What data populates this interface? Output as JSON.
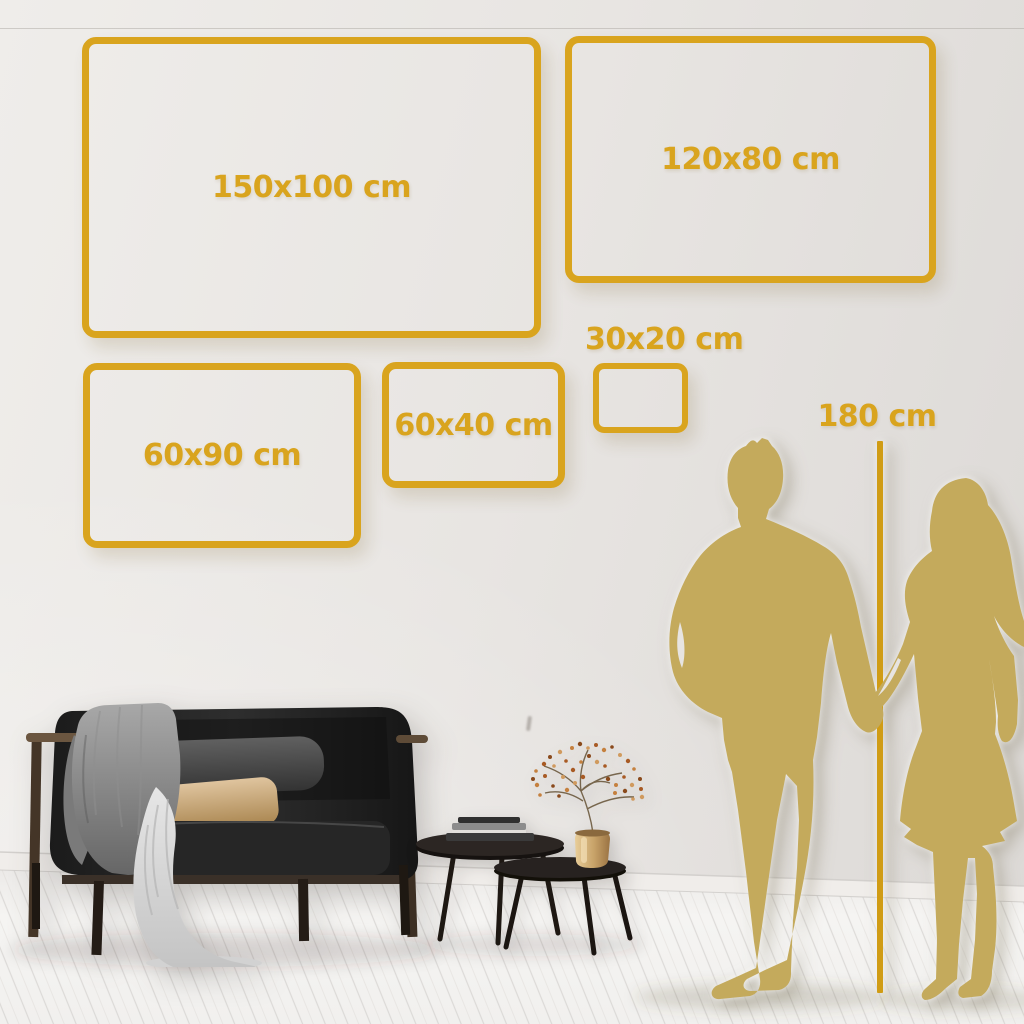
{
  "size_guide": {
    "boxes": [
      {
        "label": "150x100 cm"
      },
      {
        "label": "120x80 cm"
      },
      {
        "label": "60x90 cm"
      },
      {
        "label": "60x40 cm"
      },
      {
        "label": "30x20 cm"
      }
    ],
    "height_reference_label": "180 cm"
  },
  "colors": {
    "accent_gold": "#D9A41E",
    "measure_line_gold": "#D09C15",
    "silhouette_gold": "#C4AA5C",
    "wall_light": "#EFEDEA",
    "wall_dark": "#DCD9D6",
    "floor_light": "#F4F3F1"
  }
}
